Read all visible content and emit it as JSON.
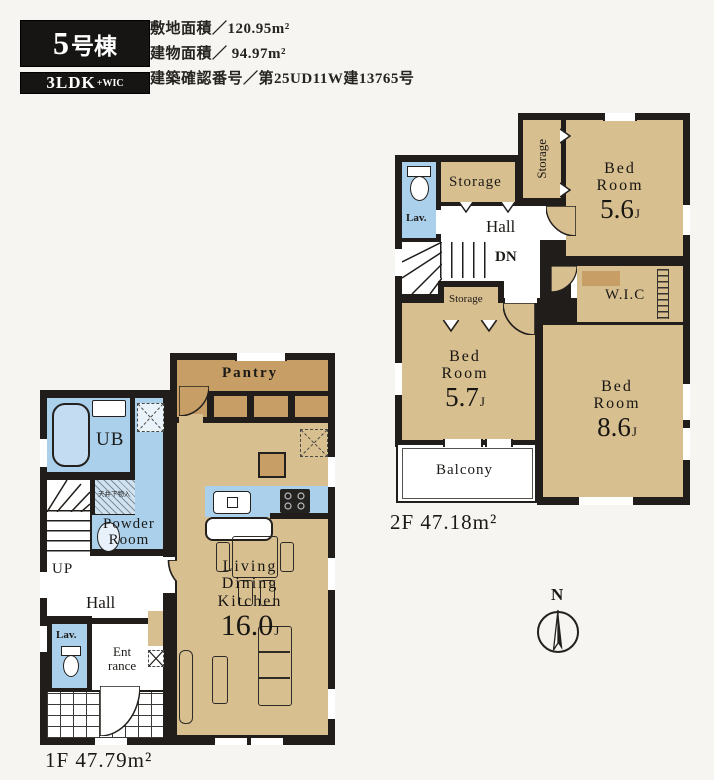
{
  "colors": {
    "wall": "#201d1a",
    "room_tan": "#d8bf90",
    "pantry_tan": "#c69e66",
    "water_blue": "#abd0ec",
    "paper": "#f6f5f1",
    "badge_bg": "#171513"
  },
  "header": {
    "unit_number": "5",
    "unit_suffix": "号棟",
    "layout_main": "3LDK",
    "layout_suffix": "+WIC",
    "info_lines": [
      "敷地面積／120.95m²",
      "建物面積／ 94.97m²",
      "建築確認番号／第25UD11W建13765号"
    ]
  },
  "floor2": {
    "area_label": "2F 47.18m²",
    "lav": "Lav.",
    "storage_top": "Storage",
    "storage_side": "Storage",
    "storage_low": "Storage",
    "hall": "Hall",
    "down": "DN",
    "wic": "W.I.C",
    "balcony": "Balcony",
    "bed1": {
      "l1": "Bed",
      "l2": "Room",
      "size": "5.6",
      "unit": "J"
    },
    "bed2": {
      "l1": "Bed",
      "l2": "Room",
      "size": "5.7",
      "unit": "J"
    },
    "bed3": {
      "l1": "Bed",
      "l2": "Room",
      "size": "8.6",
      "unit": "J"
    }
  },
  "floor1": {
    "area_label": "1F 47.79m²",
    "pantry": "Pantry",
    "ub": "UB",
    "ceiling_note": "天井下物入",
    "powder_l1": "Powder",
    "powder_l2": "Room",
    "up": "UP",
    "hall": "Hall",
    "lav": "Lav.",
    "entrance_l1": "Ent",
    "entrance_l2": "rance",
    "ldk": {
      "l1": "Living",
      "l2": "Dining",
      "l3": "Kitchen",
      "size": "16.0",
      "unit": "J"
    }
  },
  "compass": {
    "north": "N"
  }
}
